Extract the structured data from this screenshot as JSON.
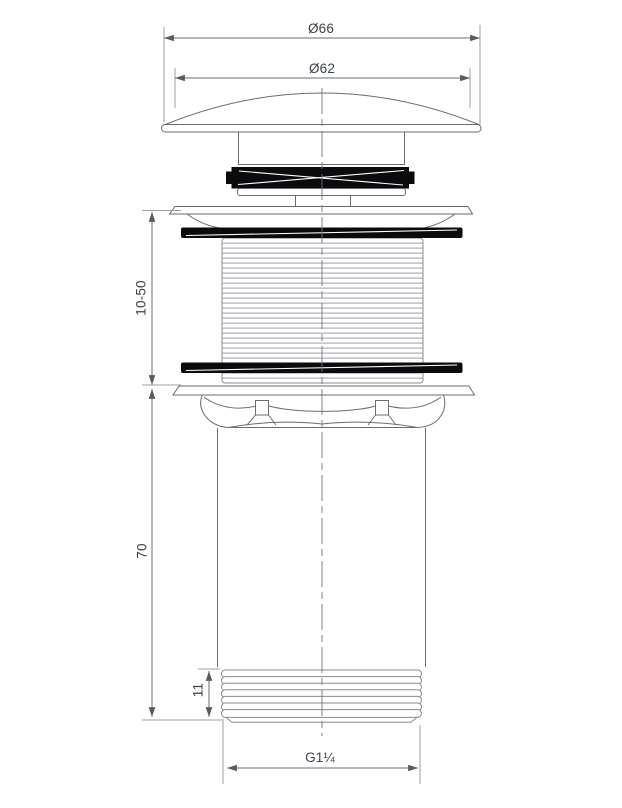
{
  "drawing": {
    "type": "technical-dimension-drawing",
    "labels": {
      "cap_outer_diameter": "Ø66",
      "cap_visible_diameter": "Ø62",
      "clamping_range": "10-50",
      "body_length": "70",
      "lower_thread_length": "11",
      "thread_size": "G1¼"
    },
    "colors": {
      "background": "#ffffff",
      "part_outline": "#6b6b73",
      "thread_line": "#9ba0a6",
      "dimension_line": "#6a6f76",
      "extension_line": "#9ba0a6",
      "seal_fill": "#0b0b0e",
      "text": "#3c424b"
    }
  }
}
